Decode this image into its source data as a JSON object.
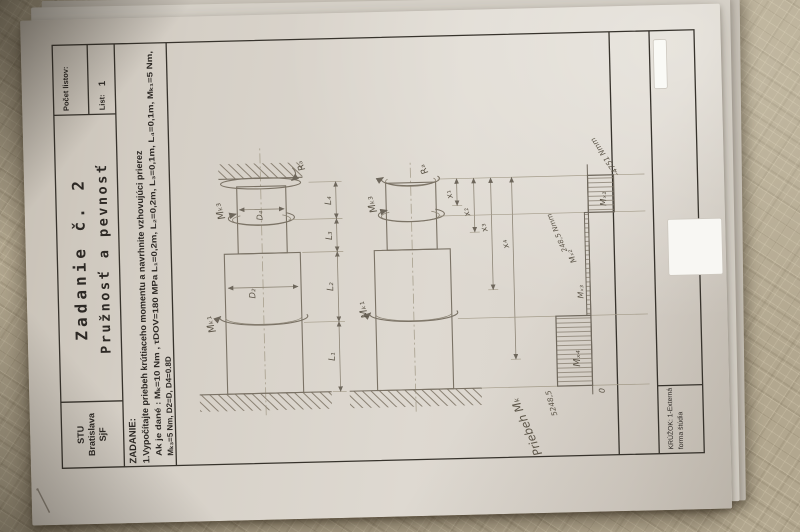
{
  "title_block": {
    "org_line1": "STU",
    "org_line2": "Bratislava",
    "org_line3": "SjF",
    "title_line1": "Zadanie č. 2",
    "title_line2": "Pružnosť a pevnosť",
    "sheet_count_label": "Počet listov:",
    "sheet_label": "List:",
    "sheet_value": "1"
  },
  "assignment": {
    "heading": "ZADANIE:",
    "task": "1.Vypočítajte priebeh krútiaceho momentu a navrhnite vzhovujúci prierez",
    "given1": "Ak je dané : Mₖ=10 Nm , τDOV=180 MPa L₁=0,2m, L₂=0,2m, L₃=0,1m, L₄=0,1m,  Mₖ₁=5 Nm,",
    "given2": "Mₖ₃=5 Nm, D2=D, D4=0.8D"
  },
  "figure1": {
    "mk1": "Mₖ₁",
    "mk3": "Mₖ₃",
    "ra": "Rₐ",
    "d2": "D₂",
    "d4": "D₄",
    "l1": "L₁",
    "l2": "L₂",
    "l3": "L₃",
    "l4": "L₄"
  },
  "figure2": {
    "mk1": "Mₖ₁",
    "mk3": "Mₖ₃",
    "ra": "Rₐ",
    "x1": "x₁",
    "x2": "x₂",
    "x3": "x₃",
    "x4": "x₄"
  },
  "diagram": {
    "title": "Priebeh Mₖ",
    "mx4": "Mₓ₄",
    "mx3": "Mₓ₃",
    "mx2": "Mₓ₂",
    "mx1": "Mₓ₁",
    "max_value": "5248,5",
    "zero": "0",
    "mx2_value": "248,5 Nmm",
    "min_value": "-4751 Nmm"
  },
  "footer": {
    "kruzok_line1": "KRÚŽOK: 1-Externá",
    "kruzok_line2": "forma štúdia"
  },
  "chart_data": {
    "type": "bar",
    "title": "Priebeh Mₖ",
    "categories": [
      "Mₓ₄",
      "Mₓ₃",
      "Mₓ₂",
      "Mₓ₁"
    ],
    "values": [
      5248.5,
      248.5,
      248.5,
      -4751
    ],
    "unit": "Nmm",
    "xlabel": "poloha po dĺžke hriadeľa",
    "ylabel": "Mₖ (Nmm)",
    "ylim": [
      -4751,
      5248.5
    ],
    "annotations": [
      "5248,5",
      "0",
      "248,5 Nmm",
      "-4751 Nmm"
    ]
  }
}
